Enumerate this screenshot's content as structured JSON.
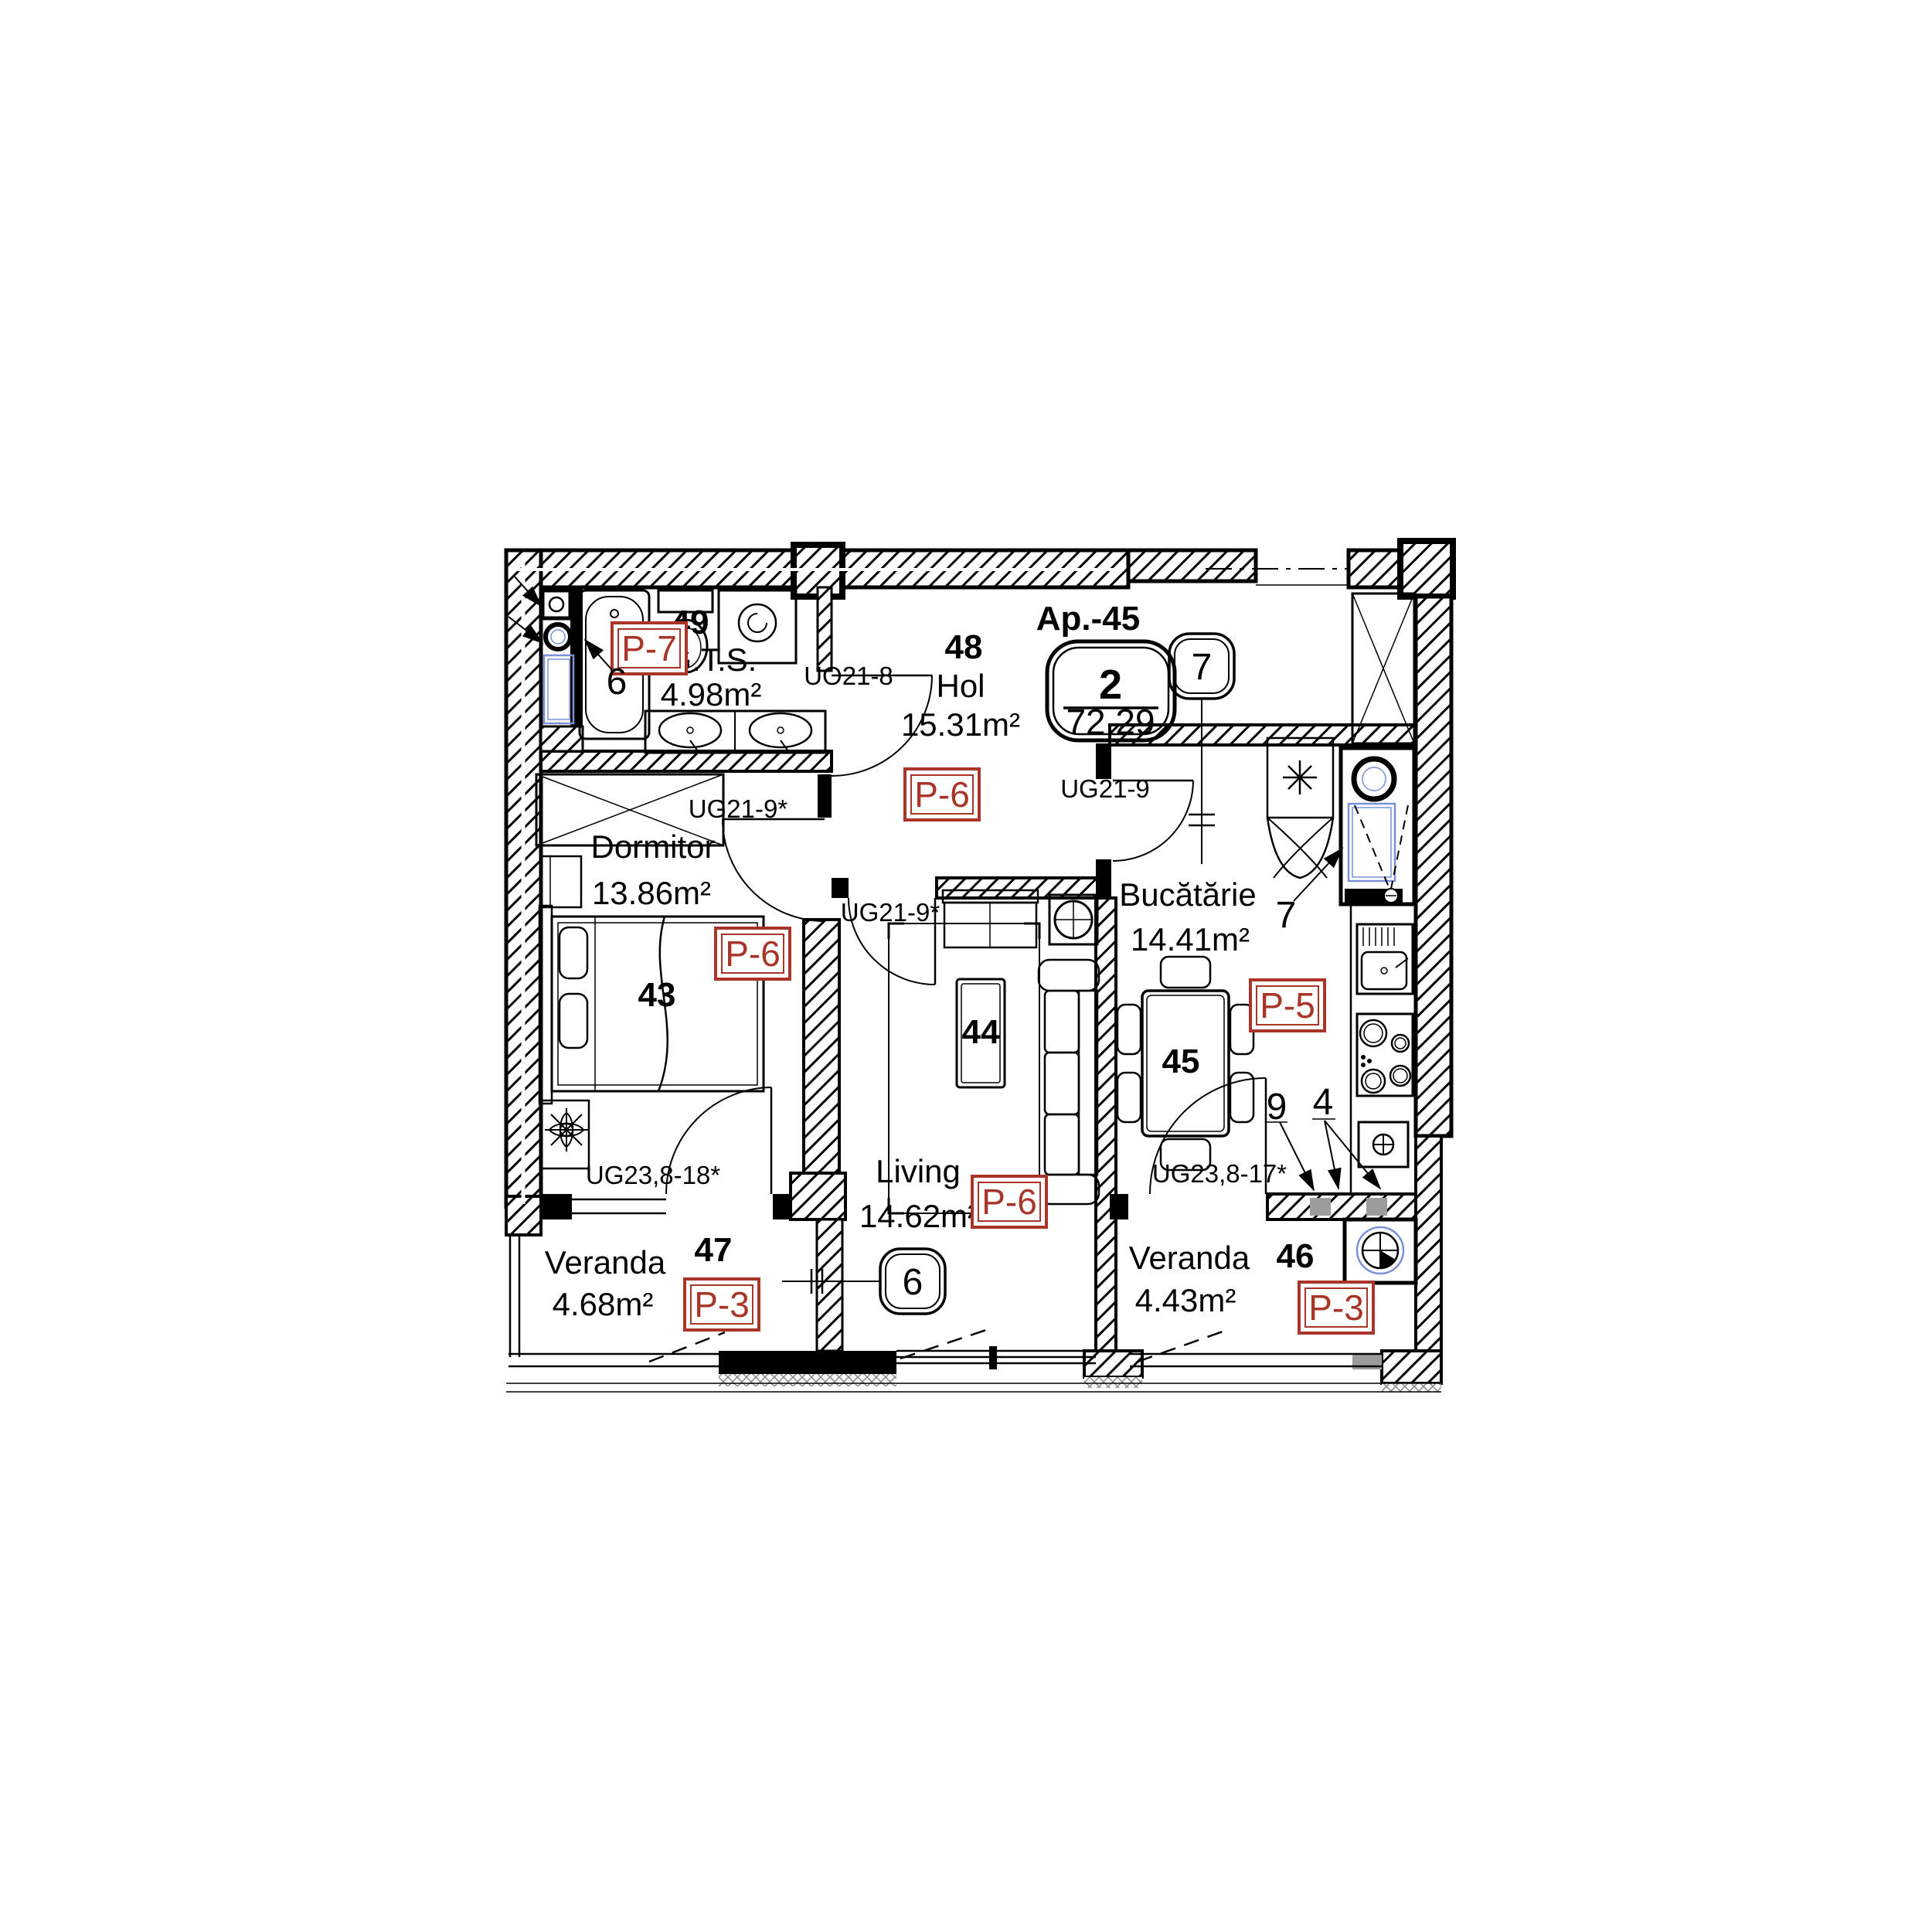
{
  "apartment_badge": {
    "name": "Ap.-45",
    "room_count": "2",
    "total_area": "72.29"
  },
  "rooms": {
    "gts": {
      "number": "49",
      "name": "G.T.S.",
      "area": "4.98m²",
      "finish_code": "P-7"
    },
    "hol": {
      "number": "48",
      "name": "Hol",
      "area": "15.31m²",
      "finish_code": "P-6"
    },
    "dormitor": {
      "number": "43",
      "name": "Dormitor",
      "area": "13.86m²",
      "finish_code": "P-6"
    },
    "living": {
      "number": "44",
      "name": "Living",
      "area": "14.62m²",
      "finish_code": "P-6"
    },
    "bucatarie": {
      "number": "45",
      "name": "Bucătărie",
      "area": "14.41m²",
      "finish_code": "P-5"
    },
    "veranda_47": {
      "number": "47",
      "name": "Veranda",
      "area": "4.68m²",
      "finish_code": "P-3"
    },
    "veranda_46": {
      "number": "46",
      "name": "Veranda",
      "area": "4.43m²",
      "finish_code": "P-3"
    }
  },
  "door_labels": {
    "gts_door": "UO21-8",
    "dormitor_door": "UG21-9*",
    "living_door": "UG21-9*",
    "kitchen_door": "UG21-9",
    "veranda47_door": "UG23,8-18*",
    "veranda46_door": "UG23,8-17*"
  },
  "axis_markers": {
    "axis_6": "6",
    "axis_7": "7"
  },
  "equipment_callouts": {
    "bath_riser": "6",
    "fridge": "7",
    "wall_segment_9": "9",
    "wall_segment_4": "4"
  },
  "colors": {
    "finish_tag_red": "#A93428",
    "plumbing_blue": "#7A90D8",
    "segment_gray": "#9C9C9C"
  }
}
